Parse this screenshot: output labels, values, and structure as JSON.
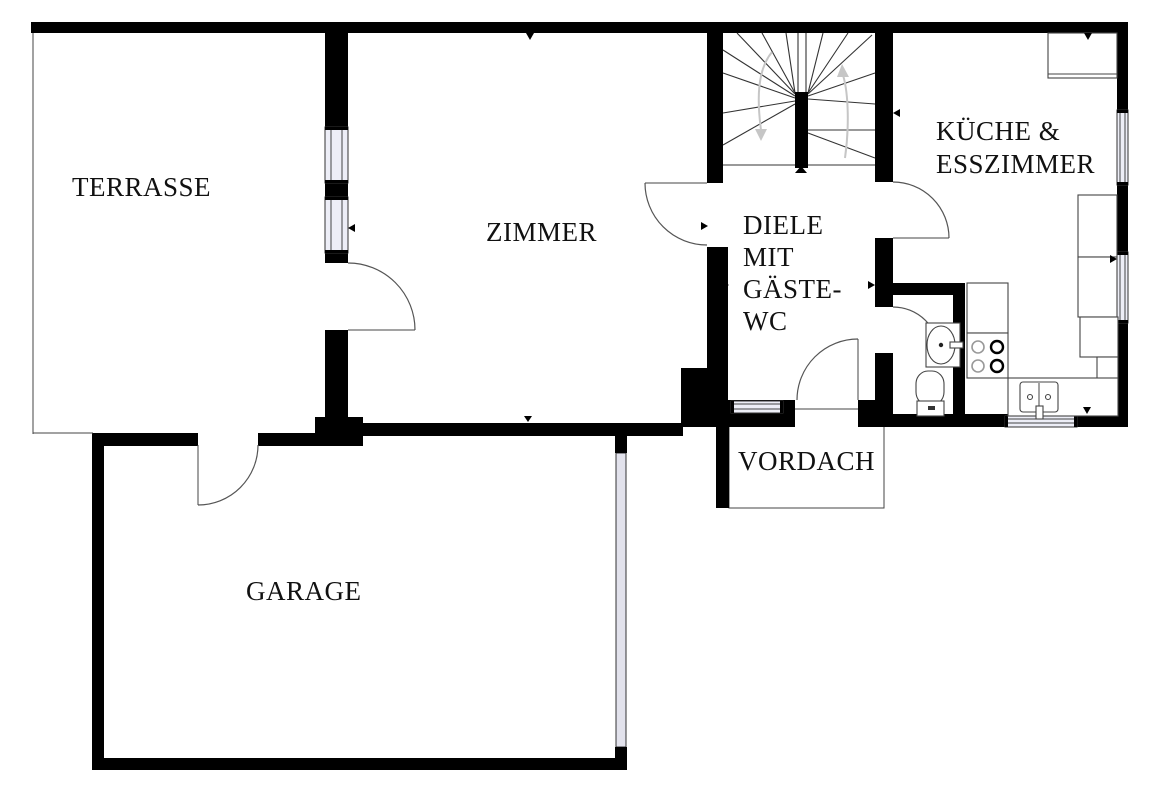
{
  "plan_title": "Erdgeschoss Grundriss",
  "colors": {
    "wall": "#000000",
    "thin_line": "#444444",
    "window_fill": "#edeef7",
    "garage_door_fill": "#e2e2ec",
    "stair_arrow_gray": "#c6c6c6",
    "background": "#ffffff"
  },
  "rooms": {
    "terrasse": {
      "label": "TERRASSE"
    },
    "zimmer": {
      "label": "ZIMMER"
    },
    "diele": {
      "lines": [
        "DIELE",
        "MIT",
        "GÄSTE-",
        "WC"
      ]
    },
    "kueche": {
      "lines": [
        "KÜCHE &",
        "ESSZIMMER"
      ]
    },
    "vordach": {
      "label": "VORDACH"
    },
    "garage": {
      "label": "GARAGE"
    }
  }
}
